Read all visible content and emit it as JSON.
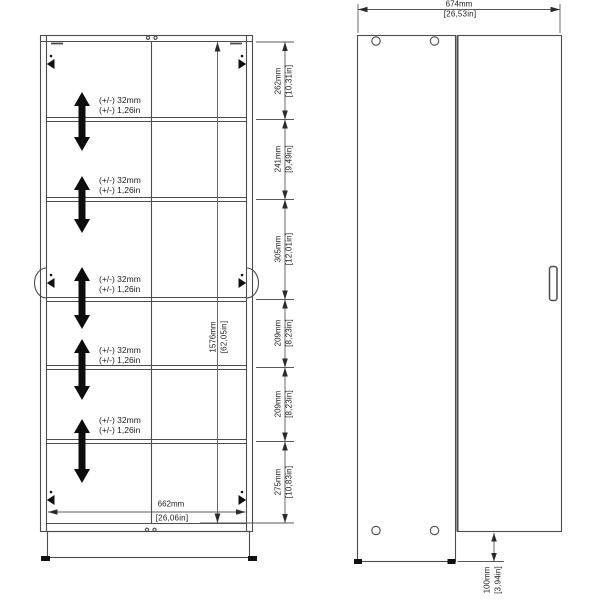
{
  "diagram": {
    "front_view": {
      "shelf_adjust": {
        "mm": "(+/-) 32mm",
        "inch": "(+/-) 1,26in"
      },
      "section_heights": [
        {
          "mm": "262mm",
          "inch": "[10,31in]"
        },
        {
          "mm": "241mm",
          "inch": "[9,49in]"
        },
        {
          "mm": "305mm",
          "inch": "[12,01in]"
        },
        {
          "mm": "209mm",
          "inch": "[8,23in]"
        },
        {
          "mm": "209mm",
          "inch": "[8,23in]"
        },
        {
          "mm": "275mm",
          "inch": "[10,83in]"
        }
      ],
      "interior_height": {
        "mm": "1576mm",
        "inch": "[62,05in]"
      },
      "interior_width": {
        "mm": "662mm",
        "inch": "[26,06in]"
      }
    },
    "side_view": {
      "overall_width": {
        "mm": "674mm",
        "inch": "[26,53in]"
      },
      "plinth_height": {
        "mm": "100mm",
        "inch": "[3,94in]"
      }
    },
    "colors": {
      "line": "#4c4c4c",
      "dim_line": "#5a5a5a",
      "arrow_fill": "#111111",
      "text": "#1c1c1c",
      "background": "#ffffff"
    }
  }
}
